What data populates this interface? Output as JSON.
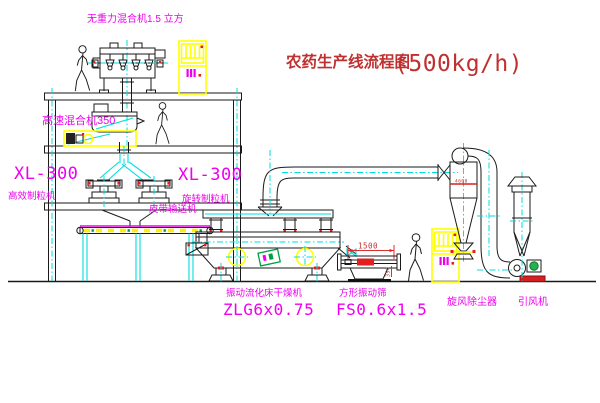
{
  "title": {
    "text": "农药生产线流程图",
    "capacity": "(500kg/h)"
  },
  "labels": {
    "gravity_mixer": "无重力混合机1.5 立方",
    "high_speed_mixer": "高速混合机350",
    "granulator_left_model": "XL-300",
    "granulator_left_name": "高效制粒机",
    "granulator_right_model": "XL-300",
    "granulator_right_name": "旋转制粒机",
    "belt_conveyor": "皮带输送机",
    "dryer_name": "振动流化床干燥机",
    "dryer_model": "ZLG6x0.75",
    "screen_name": "方形振动筛",
    "screen_model": "FS0.6x1.5",
    "cyclone": "旋风除尘器",
    "fan": "引风机"
  },
  "dimensions": {
    "screen_length": "1500",
    "screen_height": "350",
    "cyclone_mark": "4600"
  },
  "colors": {
    "label_magenta": "#EE00EE",
    "title_red": "#C03030",
    "annotation_red": "#D83030",
    "highlight_yellow": "#FFFF00",
    "centerline_cyan": "#00DEDE",
    "motor_green": "#22B14C"
  }
}
